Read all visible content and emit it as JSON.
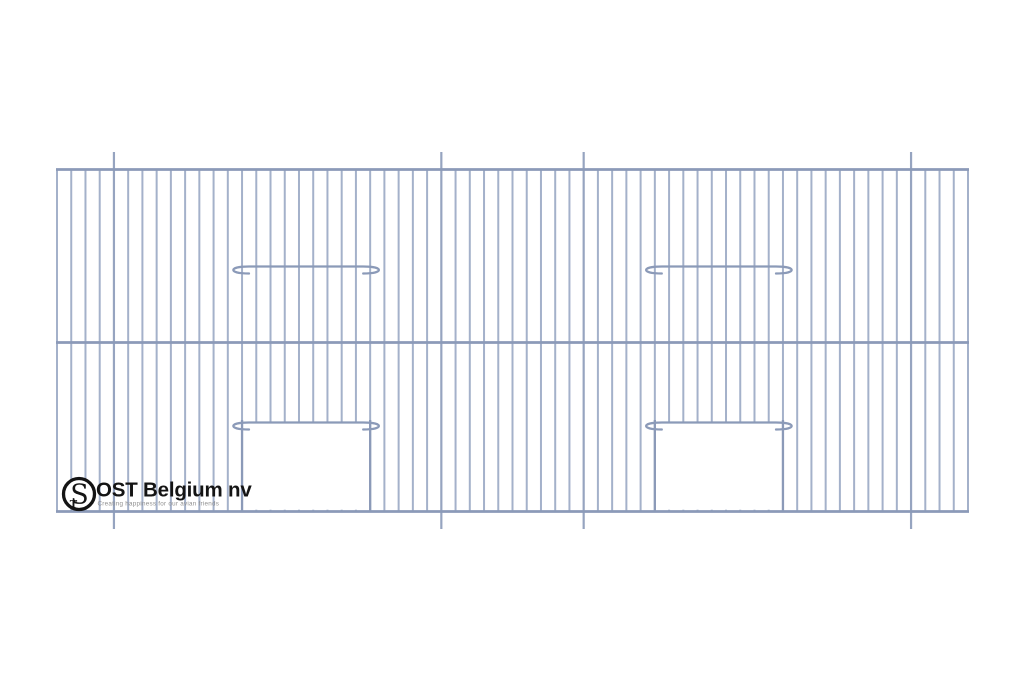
{
  "page": {
    "background": "#ffffff",
    "description": "Technical line drawing of a two-tier bird cage front panel with two door openings, two closed sliding door wires, and four hanging wires"
  },
  "brand": {
    "name": "OST Belgium nv",
    "tagline": "Creating happiness for our avian friends",
    "monogram": {
      "letter_large": "S",
      "letter_small": "T"
    },
    "text_color": "#141414",
    "tagline_color": "#8f8f8f",
    "ring_color": "#141414",
    "ring_fill": "#ffffff"
  },
  "drawing": {
    "type": "cage-front-panel",
    "colors": {
      "wire": "#a4b1ca",
      "hanger_wire": "#96a4c0",
      "rail": "#8b9ab8",
      "frame": "#8b9ab8",
      "opening_fill": "#ffffff"
    },
    "panel": {
      "left": 57,
      "right": 968,
      "top": 169.5,
      "middle_rail_y": 342.5,
      "bottom": 511.5
    },
    "vertical_wires": {
      "count": 65,
      "spacing": 14.2344
    },
    "hanger_wire_indices": [
      4,
      27,
      37,
      60
    ],
    "hanger_extension": 17.5,
    "doors": [
      {
        "left_wire_index": 13,
        "right_wire_index": 22,
        "slide_wire_y": 426
      },
      {
        "left_wire_index": 42,
        "right_wire_index": 51,
        "slide_wire_y": 426
      }
    ],
    "perch_hooks": [
      {
        "left_wire_index": 13,
        "right_wire_index": 22,
        "y": 266.5
      },
      {
        "left_wire_index": 42,
        "right_wire_index": 51,
        "y": 266.5
      }
    ],
    "stroke": {
      "wire_width": 2,
      "hanger_width": 2.2,
      "rail_width": 2.7,
      "frame_width": 2.3,
      "hook_width": 2.2
    }
  },
  "logo_layout": {
    "circle": {
      "cx": 79,
      "cy": 494,
      "r": 15.5,
      "stroke_width": 3.3
    }
  }
}
